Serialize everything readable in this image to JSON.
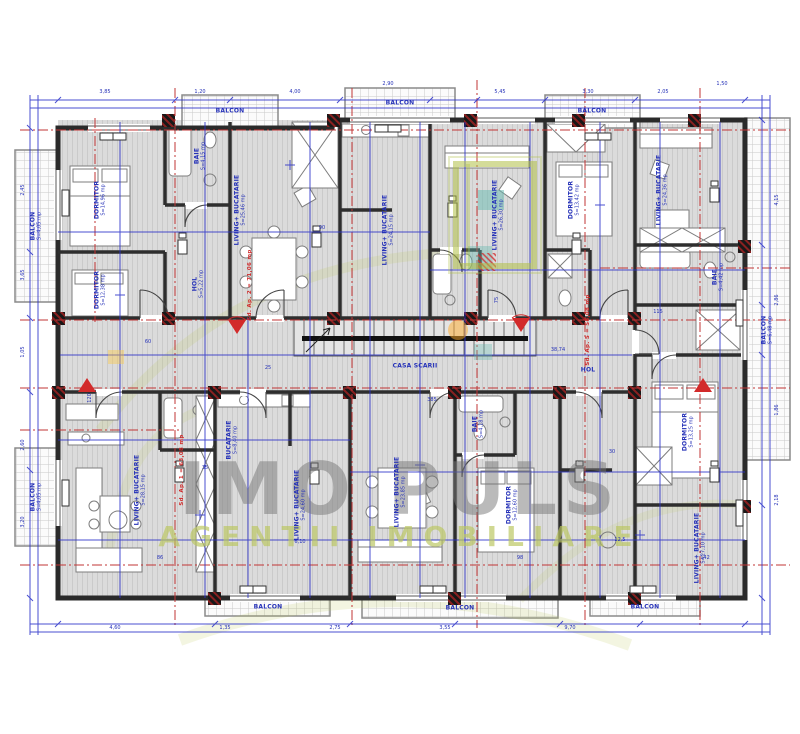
{
  "watermark": {
    "title": "IMO PULS",
    "subtitle": "AGENTII IMOBILIARE"
  },
  "stair_label": "CASA SCARII",
  "corridor_dim": "38,74",
  "red_annotations": [
    "Sd. Ap. 2 = 71,06 mp",
    "Sd. Ap. 5 = 58,08 mp",
    "Sd. Ap. 1 = 63,08 mp"
  ],
  "rooms": [
    {
      "name": "BALCON",
      "area": "S=4,05 mp"
    },
    {
      "name": "DORMITOR",
      "area": "S=14,96 mp"
    },
    {
      "name": "DORMITOR",
      "area": "S=12,38 mp"
    },
    {
      "name": "BAIE",
      "area": "S=4,15 mp"
    },
    {
      "name": "HOL",
      "area": "S=5,22 mp"
    },
    {
      "name": "LIVING+ BUCATARIE",
      "area": "S=25,46 mp"
    },
    {
      "name": "LIVING+ BUCATARIE",
      "area": "S=24,15 mp"
    },
    {
      "name": "BALCON",
      "area": "S=3,12 mp"
    },
    {
      "name": "LIVING+ BUCATARIE",
      "area": "S=26,30 mp"
    },
    {
      "name": "DORMITOR",
      "area": "S=13,42 mp"
    },
    {
      "name": "BALCON",
      "area": "S=6,48 mp"
    },
    {
      "name": "LIVING+ BUCATARIE",
      "area": "S=24,36 mp"
    },
    {
      "name": "BAIE",
      "area": "S=4,42 mp"
    },
    {
      "name": "LIVING+ BUCATARIE",
      "area": "S=28,15 mp"
    },
    {
      "name": "BALCON",
      "area": "S=4,05 mp"
    },
    {
      "name": "BUCATARIE",
      "area": "S=8,40 mp"
    },
    {
      "name": "LIVING+ BUCATARIE",
      "area": "S=24,60 mp"
    },
    {
      "name": "LIVING+ BUCATARIE",
      "area": "S=23,85 mp"
    },
    {
      "name": "DORMITOR",
      "area": "S=12,60 mp"
    },
    {
      "name": "BAIE",
      "area": "S=4,18 mp"
    },
    {
      "name": "DORMITOR",
      "area": "S=13,25 mp"
    },
    {
      "name": "LIVING+ BUCATARIE",
      "area": "S=27,10 mp"
    },
    {
      "name": "BALCON",
      "area": "S=5,20 mp"
    },
    {
      "name": "BALCON",
      "area": "S=7,36 mp"
    },
    {
      "name": "BALCON",
      "area": "S=5,18 mp"
    },
    {
      "name": "BALCON",
      "area": "S=3,26 mp"
    },
    {
      "name": "BALCON",
      "area": "S=3,30 mp"
    },
    {
      "name": "HOL",
      "area": "S=6,12 mp"
    }
  ],
  "dims": [
    "3,85",
    "1,20",
    "4,00",
    "2,90",
    "5,45",
    "3,30",
    "2,05",
    "1,50",
    "2,45",
    "3,65",
    "1,05",
    "2,60",
    "3,20",
    "4,15",
    "2,86",
    "1,86",
    "2,18",
    "4,60",
    "1,35",
    "2,75",
    "3,55",
    "9,70",
    "60",
    "25",
    "90",
    "75",
    "35",
    "30",
    "115",
    "120",
    "385",
    "142",
    "98",
    "86",
    "6,10",
    "12,5"
  ]
}
